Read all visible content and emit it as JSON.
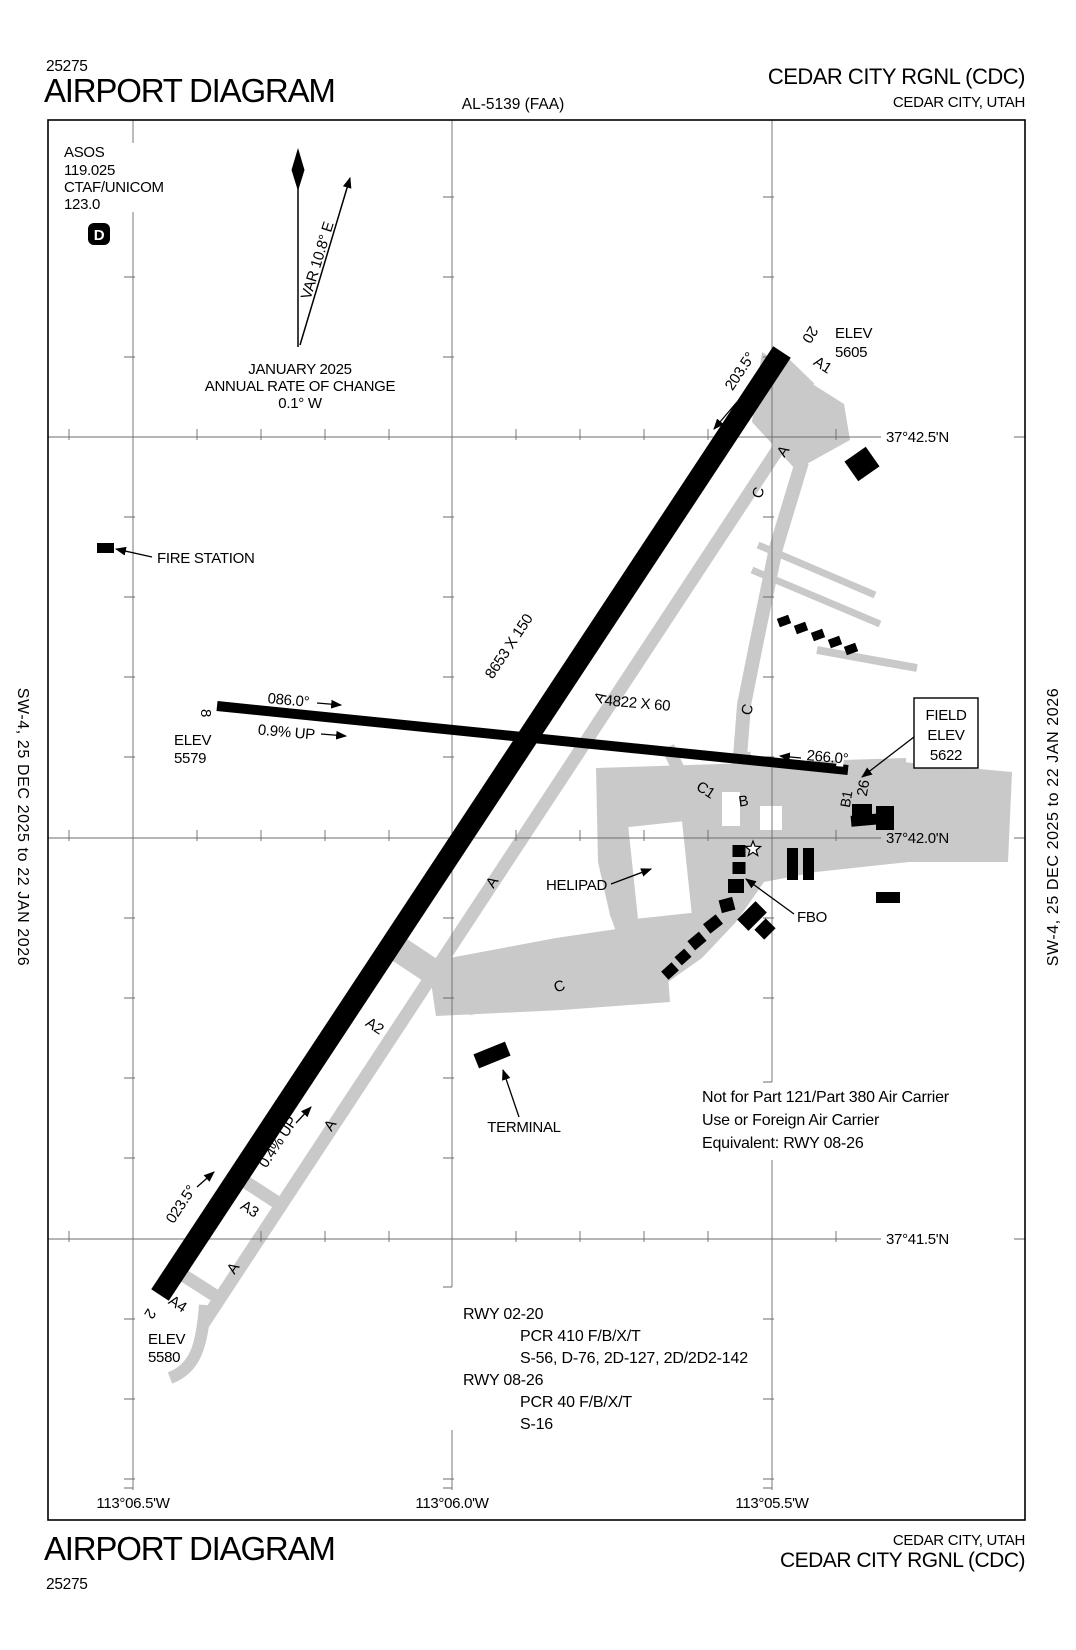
{
  "header": {
    "chart_number": "25275",
    "title": "AIRPORT DIAGRAM",
    "al_number": "AL-5139 (FAA)",
    "airport": "CEDAR CITY RGNL (CDC)",
    "city": "CEDAR CITY, UTAH"
  },
  "footer": {
    "title": "AIRPORT DIAGRAM",
    "chart_number": "25275",
    "airport": "CEDAR CITY RGNL (CDC)",
    "city": "CEDAR CITY, UTAH"
  },
  "sides": {
    "left": "SW-4,  25 DEC 2025  to  22 JAN 2026",
    "right": "SW-4,  25 DEC 2025  to  22 JAN 2026"
  },
  "info_box": {
    "asos_label": "ASOS",
    "asos_freq": "119.025",
    "ctaf_label": "CTAF/UNICOM",
    "ctaf_freq": "123.0",
    "class_d": "D"
  },
  "variation": {
    "label": "VAR 10.8° E",
    "month": "JANUARY 2025",
    "rate_label": "ANNUAL RATE OF CHANGE",
    "rate_value": "0.1° W"
  },
  "grid": {
    "lat_labels": [
      "37°42.5'N",
      "37°42.0'N",
      "37°41.5'N"
    ],
    "lon_labels": [
      "113°06.5'W",
      "113°06.0'W",
      "113°05.5'W"
    ]
  },
  "runway_02_20": {
    "dimensions": "8653 X 150",
    "end_low": "2",
    "end_high": "20",
    "heading_high": "203.5°",
    "heading_low": "023.5°",
    "gradient": "0.4% UP",
    "elev_label": "ELEV",
    "elev_20": "5605",
    "elev_2": "5580"
  },
  "runway_08_26": {
    "dimensions": "4822 X 60",
    "end_low": "8",
    "end_high": "26",
    "heading_low": "086.0°",
    "heading_high": "266.0°",
    "gradient": "0.9% UP",
    "elev_label": "ELEV",
    "elev_8": "5579"
  },
  "field_elevation": {
    "line1": "FIELD",
    "line2": "ELEV",
    "line3": "5622"
  },
  "taxiways": {
    "a": "A",
    "a1": "A1",
    "a2": "A2",
    "a3": "A3",
    "a4": "A4",
    "b": "B",
    "b1": "B1",
    "c": "C",
    "c1": "C1"
  },
  "facilities": {
    "fire_station": "FIRE STATION",
    "helipad": "HELIPAD",
    "fbo": "FBO",
    "terminal": "TERMINAL"
  },
  "notes": {
    "line1": "Not for Part 121/Part 380 Air Carrier",
    "line2": "Use or Foreign Air Carrier",
    "line3": "Equivalent: RWY 08-26"
  },
  "runway_data": {
    "rwy1_id": "RWY 02-20",
    "rwy1_pcr": "PCR 410 F/B/X/T",
    "rwy1_ratings": "S-56, D-76, 2D-127, 2D/2D2-142",
    "rwy2_id": "RWY 08-26",
    "rwy2_pcr": "PCR 40 F/B/X/T",
    "rwy2_ratings": "S-16"
  }
}
